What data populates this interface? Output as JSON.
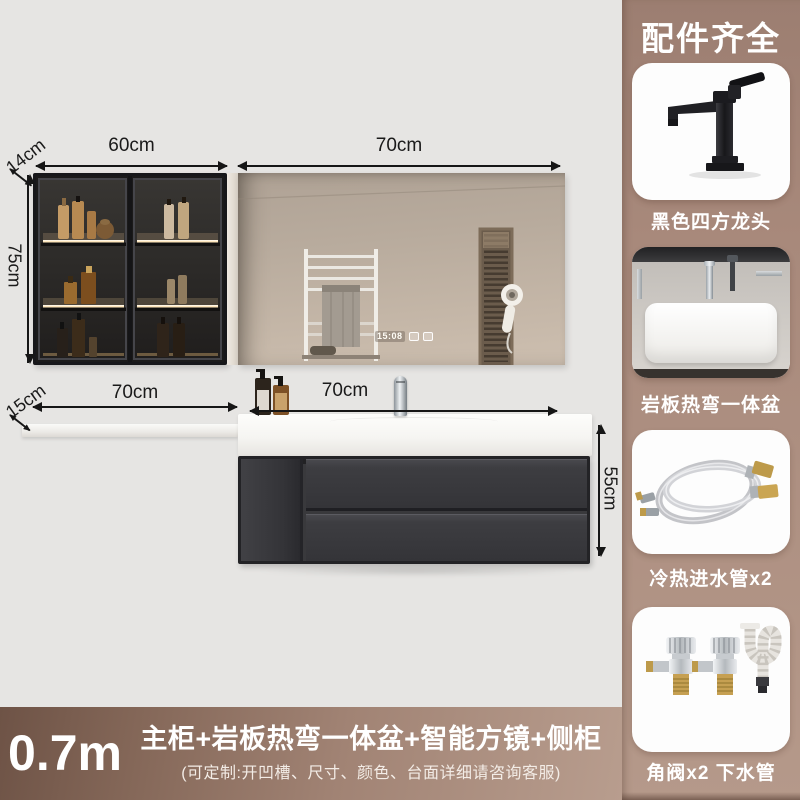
{
  "page": {
    "background": "#e6e5e3",
    "accent_brown": "#a8897b",
    "bar_gradient_left": "#6e5346",
    "bar_gradient_right": "#b89d8e"
  },
  "dimensions": {
    "cabinet_width": "60cm",
    "cabinet_depth": "14cm",
    "cabinet_height": "75cm",
    "mirror_width": "70cm",
    "shelf_width": "70cm",
    "shelf_depth": "15cm",
    "vanity_width": "70cm",
    "vanity_height": "55cm"
  },
  "mirror": {
    "clock": "15:08"
  },
  "sidebar": {
    "title": "配件齐全",
    "items": [
      {
        "label": "黑色四方龙头",
        "icon": "black-square-faucet"
      },
      {
        "label": "岩板热弯一体盆",
        "icon": "slate-basin-photo"
      },
      {
        "label": "冷热进水管x2",
        "icon": "braided-hoses"
      },
      {
        "label": "角阀x2 下水管",
        "icon": "angle-valves-drain-pipe"
      }
    ]
  },
  "footer": {
    "size": "0.7m",
    "title": "主柜+岩板热弯一体盆+智能方镜+侧柜",
    "subtitle": "(可定制:开凹槽、尺寸、颜色、台面详细请咨询客服)"
  }
}
